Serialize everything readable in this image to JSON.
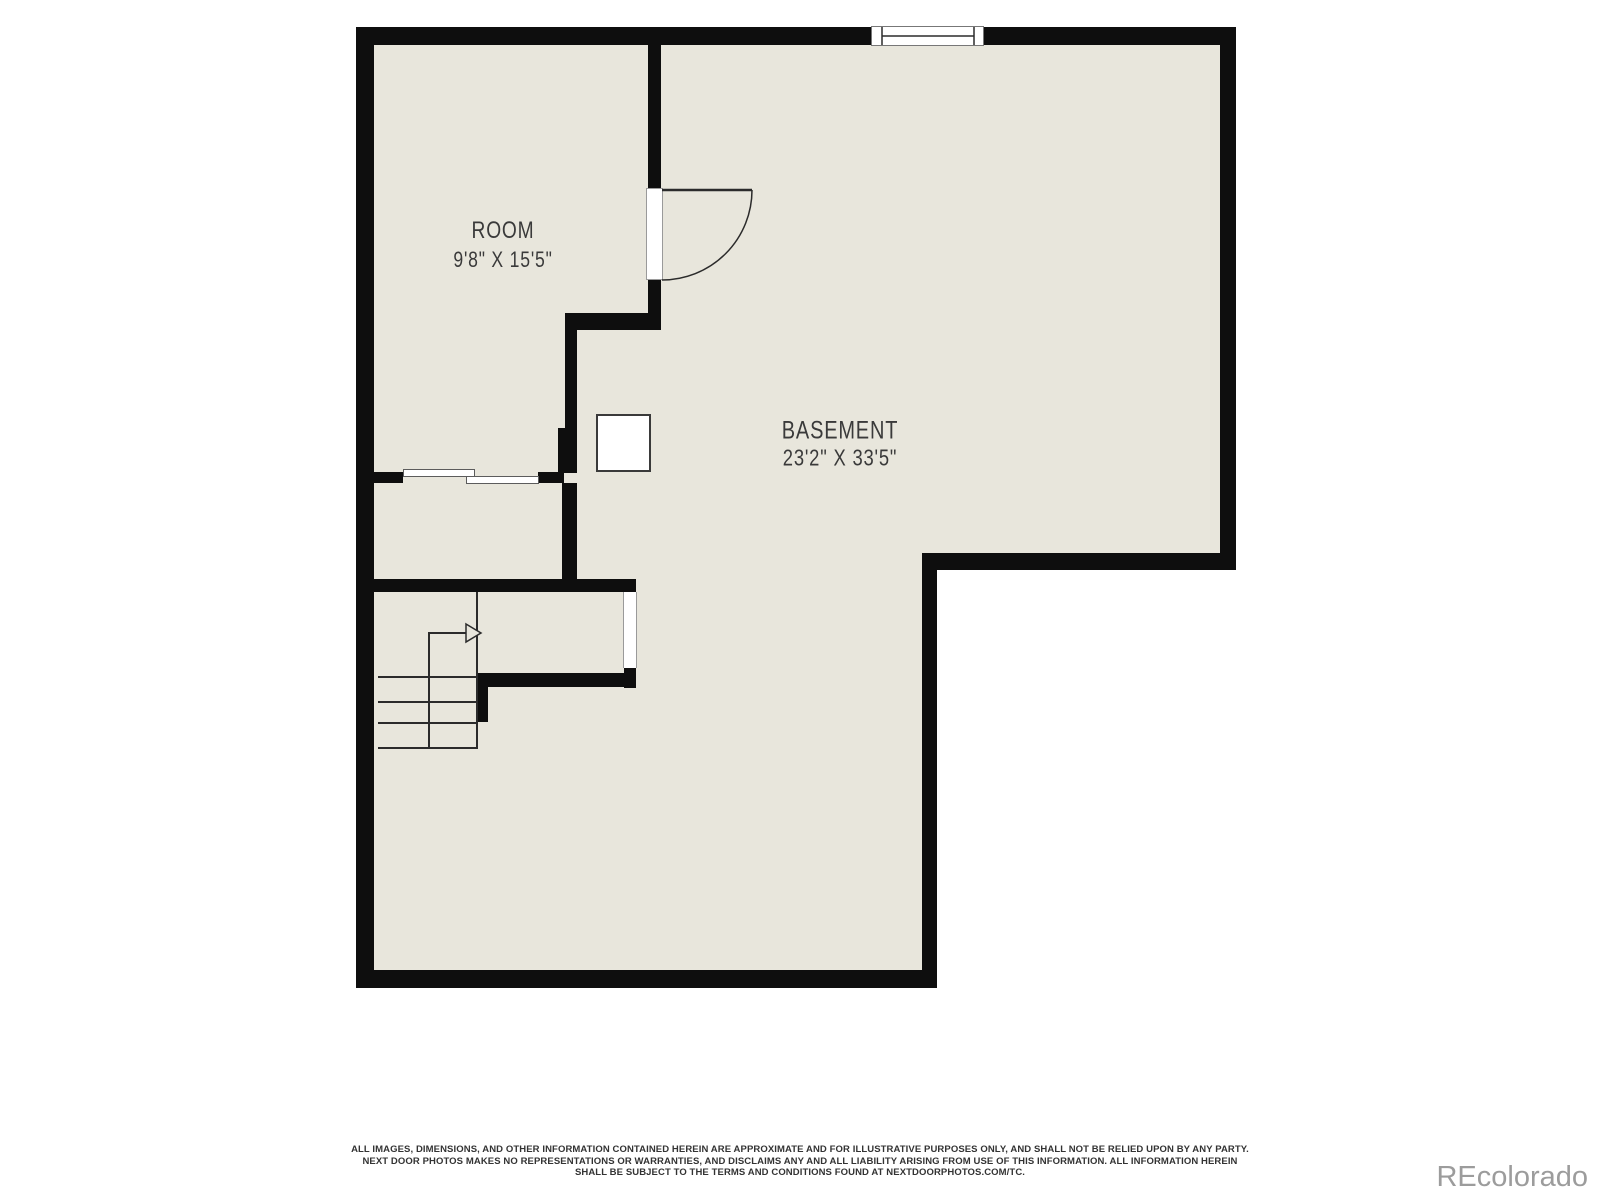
{
  "colors": {
    "background": "#ffffff",
    "floor": "#e8e6dc",
    "wall": "#0e0e0e",
    "line": "#2b2b2b",
    "label": "#3a3a3a",
    "disclaimer": "#333333",
    "watermark": "#9c9c9c"
  },
  "rooms": [
    {
      "name": "ROOM",
      "dimensions": "9'8\" X 15'5\""
    },
    {
      "name": "BASEMENT",
      "dimensions": "23'2\" X 33'5\""
    }
  ],
  "icons": [
    "door-swing-icon",
    "window-icon",
    "stairs-icon",
    "stairs-direction-arrow",
    "utility-box"
  ],
  "disclaimer": {
    "line1": "ALL IMAGES, DIMENSIONS, AND OTHER INFORMATION CONTAINED HEREIN ARE APPROXIMATE AND FOR ILLUSTRATIVE PURPOSES ONLY, AND SHALL NOT BE RELIED UPON BY ANY PARTY.",
    "line2": "NEXT DOOR PHOTOS MAKES NO REPRESENTATIONS OR WARRANTIES, AND DISCLAIMS ANY AND ALL LIABILITY ARISING FROM USE OF THIS INFORMATION. ALL INFORMATION HEREIN",
    "line3": "SHALL BE SUBJECT TO THE TERMS AND CONDITIONS FOUND AT NEXTDOORPHOTOS.COM/TC."
  },
  "watermark": "REcolorado"
}
